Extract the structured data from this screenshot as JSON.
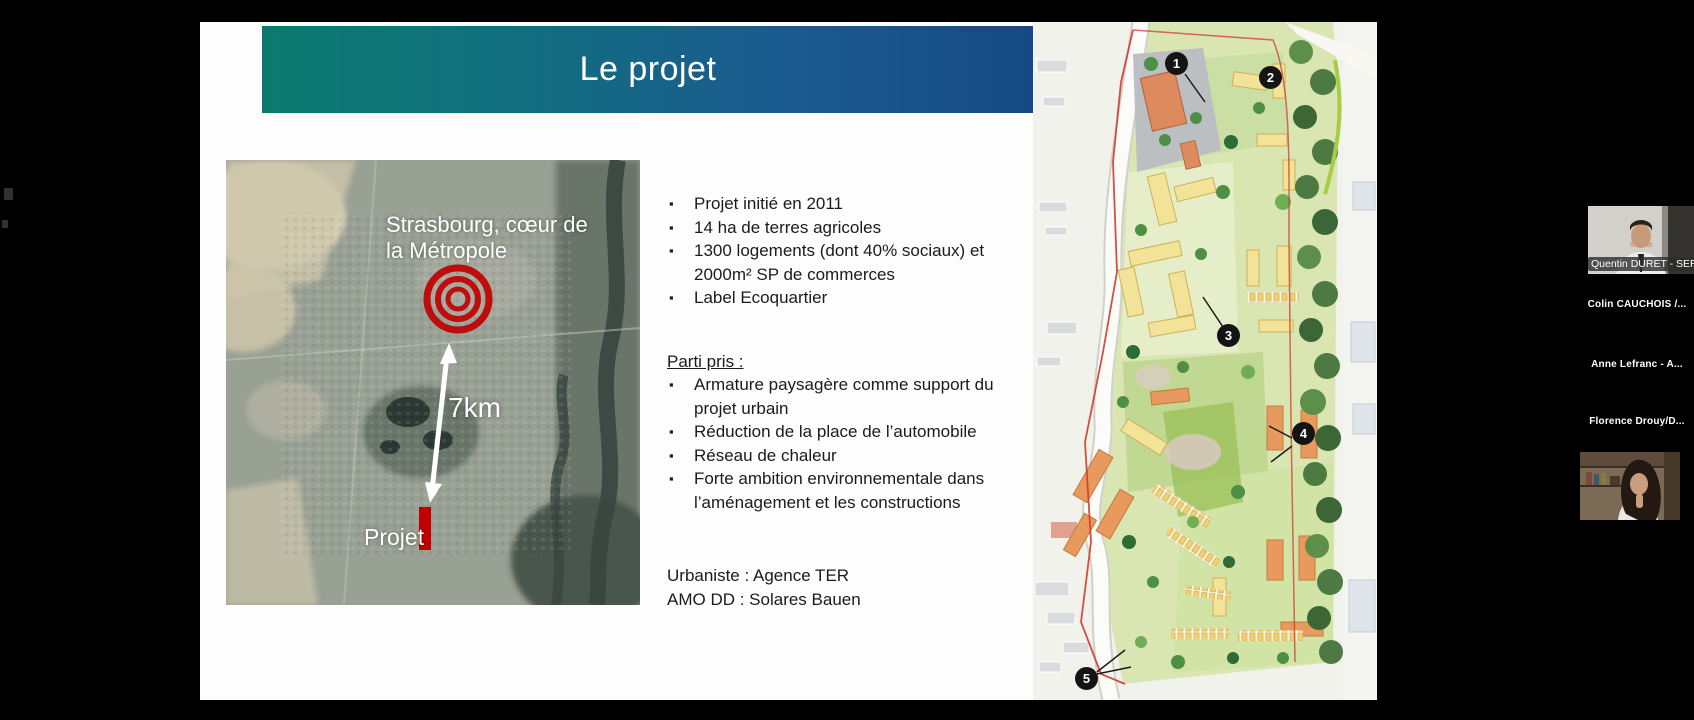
{
  "slide": {
    "title": "Le projet",
    "banner_colors": {
      "from": "#0b7a6e",
      "to": "#174a85"
    },
    "map": {
      "label_city": "Strasbourg, cœur de la Métropole",
      "label_distance": "7km",
      "label_site": "Projet",
      "accent_red": "#c00000"
    },
    "bullets_main": [
      "Projet initié en 2011",
      "14 ha de terres agricoles",
      "1300 logements (dont 40% sociaux) et 2000m² SP de commerces",
      "Label Ecoquartier"
    ],
    "parti_pris_heading": "Parti pris :",
    "bullets_parti": [
      "Armature paysagère comme support du projet urbain",
      "Réduction de la place de l’automobile",
      "Réseau de chaleur",
      "Forte ambition environnementale dans l’aménagement et les constructions"
    ],
    "credits": [
      "Urbaniste : Agence TER",
      "AMO DD : Solares Bauen"
    ],
    "plan_markers": [
      "1",
      "2",
      "3",
      "4",
      "5"
    ]
  },
  "participants": [
    {
      "name": "Quentin DURET - SERS",
      "video": true
    },
    {
      "name": "Colin CAUCHOIS /...",
      "video": false
    },
    {
      "name": "Anne Lefranc - A...",
      "video": false
    },
    {
      "name": "Florence  Drouy/D...",
      "video": false
    },
    {
      "name": "",
      "video": true
    }
  ]
}
